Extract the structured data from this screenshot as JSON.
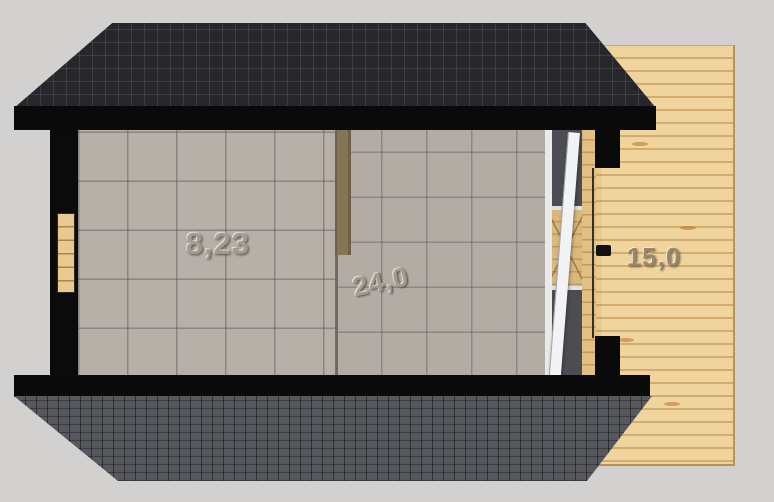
{
  "plan": {
    "rooms": {
      "left": {
        "area_label": "8,23"
      },
      "right": {
        "area_label": "24,0"
      },
      "terrace": {
        "area_label": "15,0"
      }
    },
    "colors": {
      "background": "#d2d1cf",
      "roof_top": "#26262b",
      "roof_bottom": "#56585e",
      "eaves_and_walls": "#0a0a0a",
      "floor_tiles": "#b6b0a8",
      "terrace_wood": "#f0d49e",
      "partition_wood": "#857555",
      "window_wood": "#e9c98e",
      "glazing_glass": "#4b4d52",
      "door_panel_white": "#f2f3f4"
    }
  }
}
